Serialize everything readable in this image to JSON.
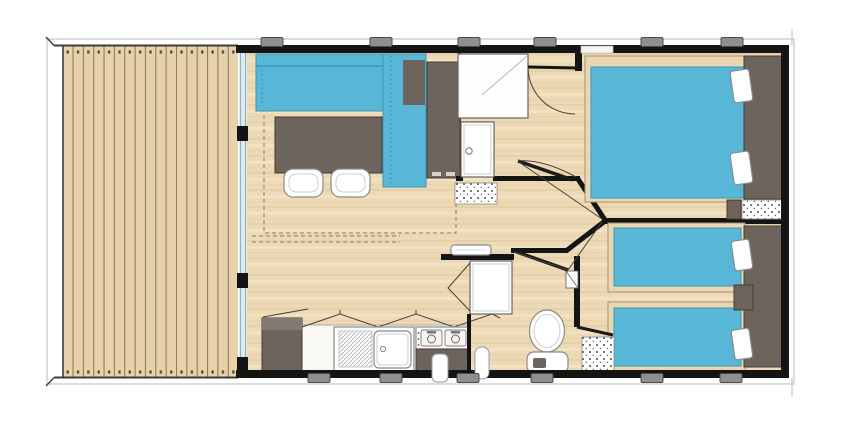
{
  "title": "Mobile home floor plan with terrace, living room, kitchen, bathroom, WC and two bedrooms",
  "colors": {
    "wall": "#141414",
    "floor_base": "#ecd9b5",
    "floor_grain_dark": "#e2cba1",
    "floor_grain_light": "#f4e5c6",
    "deck_base": "#e8d2ab",
    "deck_line": "#8d7c5f",
    "accent_blue": "#58b7d6",
    "accent_blue_edge": "#3b98b8",
    "furniture_dark": "#6e645e",
    "furniture_dark_edge": "#453c34",
    "fixture_white": "#ffffff",
    "window_tab": "#8f8f8f",
    "window_tab_edge": "#4c4c4c",
    "glass": "#dfe9ed",
    "glass_line": "#8fb0bd",
    "roof_hairline": "#c4c4c4",
    "dash_guide": "#8b7a5e"
  },
  "rooms": [
    {
      "name": "terrace-deck"
    },
    {
      "name": "living-room"
    },
    {
      "name": "kitchen"
    },
    {
      "name": "bathroom"
    },
    {
      "name": "wc"
    },
    {
      "name": "hallway"
    },
    {
      "name": "bedroom-1"
    },
    {
      "name": "bedroom-2"
    }
  ],
  "furniture_icons": [
    "corner-sofa",
    "dining-table",
    "chair",
    "chair",
    "wardrobe",
    "side-unit",
    "fridge-cabinet",
    "kitchen-sink",
    "stove-two-burners",
    "stove-cabinet",
    "overhead-cupboards",
    "shower-tray",
    "bathroom-door",
    "bath-mat",
    "wc-toilet",
    "wc-folding-door",
    "wc-shelf",
    "water-heater",
    "double-bed",
    "single-bed",
    "single-bed",
    "headboard",
    "nightstand",
    "pillow",
    "pillow",
    "pillow",
    "pillow",
    "door-mat",
    "door-mat",
    "door-mat"
  ],
  "windows": {
    "top_tab_centers_x": [
      272,
      381,
      469,
      545,
      652,
      732
    ],
    "top_tab_y": 37.5,
    "bottom_tab_centers_x": [
      319,
      391,
      468,
      542,
      652,
      731
    ],
    "bottom_tab_y": 373.5,
    "tab_width": 22,
    "tab_height": 9
  }
}
